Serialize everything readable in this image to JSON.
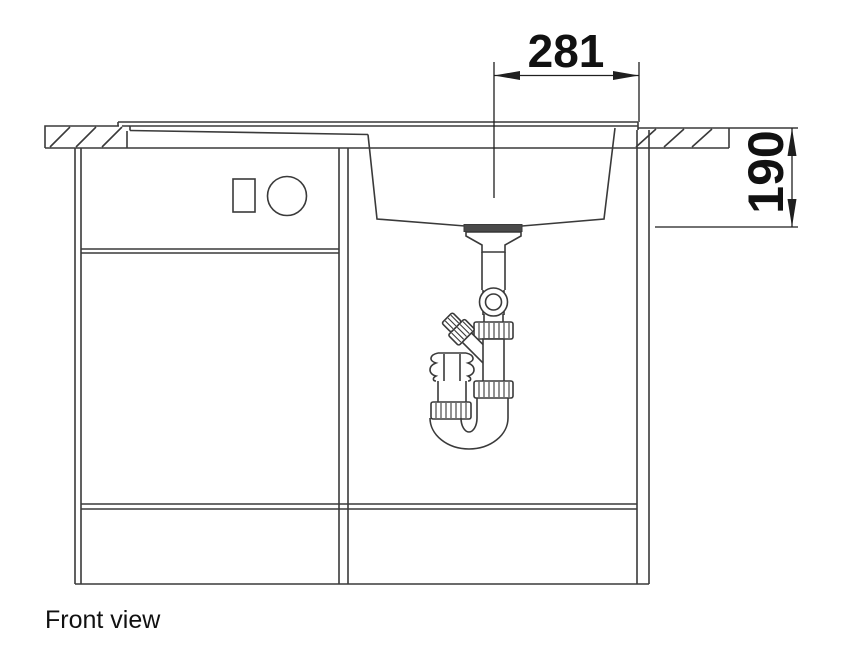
{
  "caption": "Front view",
  "dimensions": {
    "width": {
      "value": "281"
    },
    "depth": {
      "value": "190"
    }
  },
  "colors": {
    "line": "#3a3a3a",
    "dimension": "#1f1f1f",
    "text": "#111111",
    "background": "#ffffff",
    "drain": "#4a4a4a"
  }
}
